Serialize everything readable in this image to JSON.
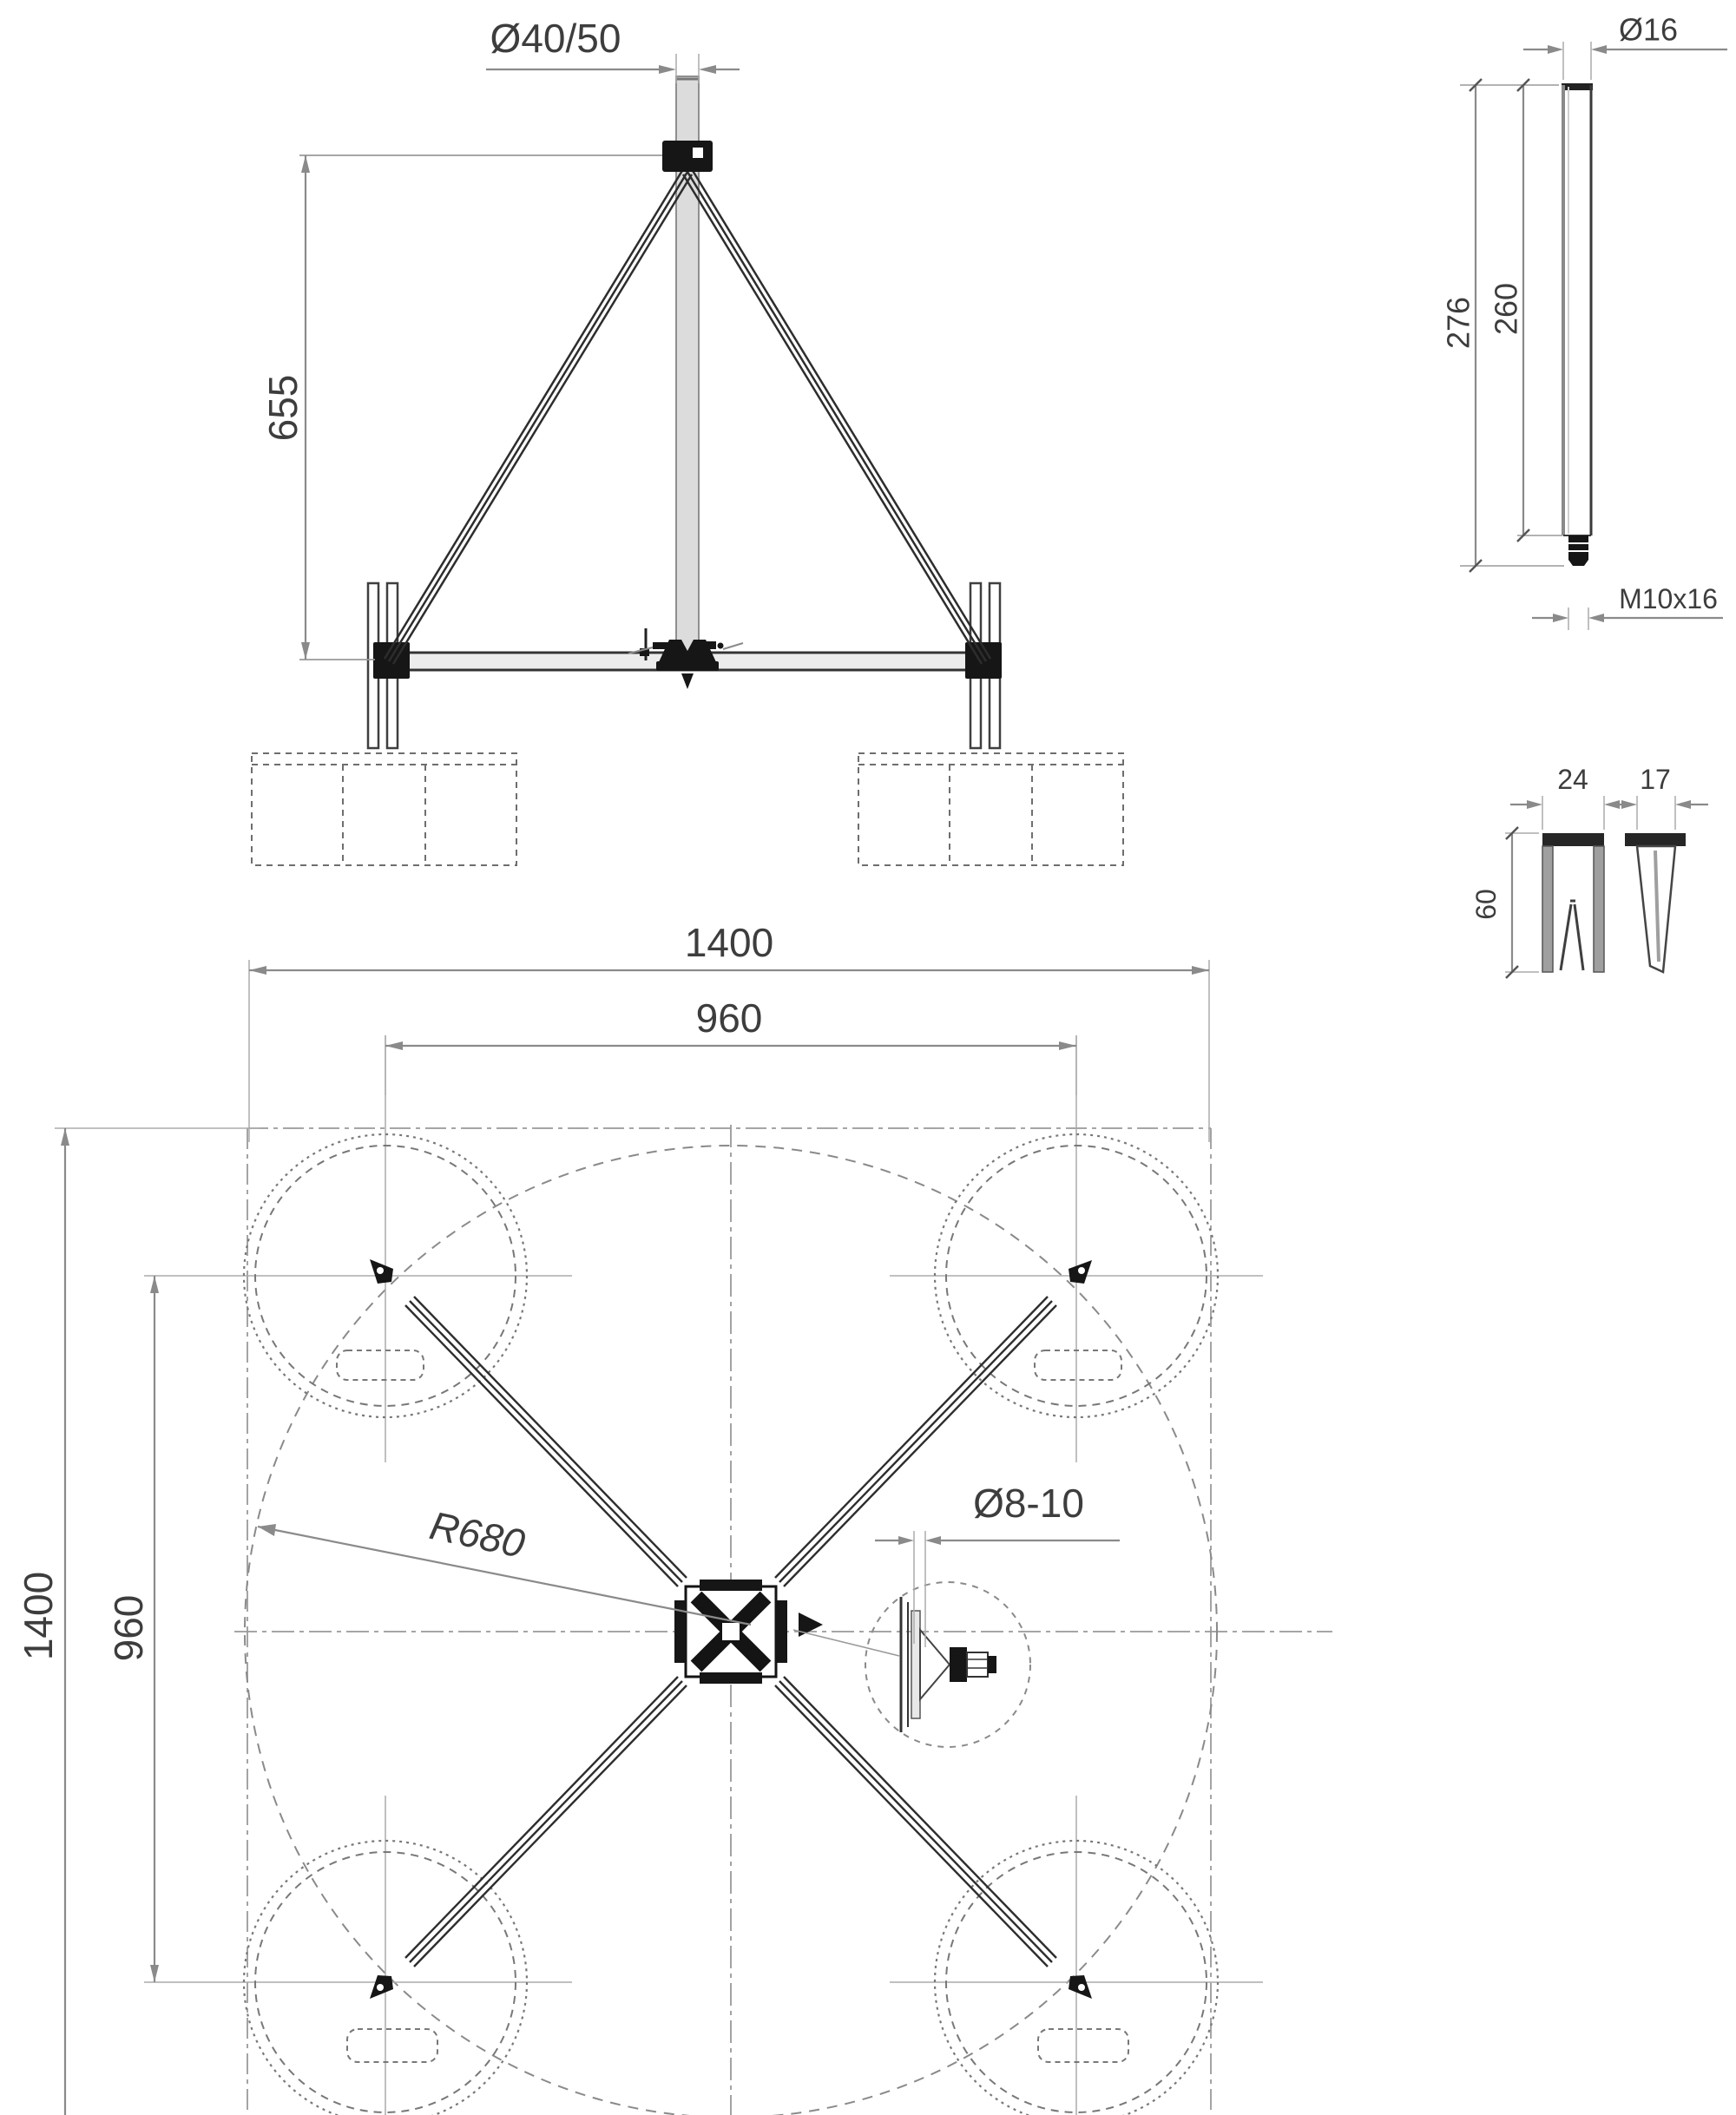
{
  "front": {
    "mast_diameter": "Ø40/50",
    "height": "655"
  },
  "rod": {
    "diameter": "Ø16",
    "overall_length": "276",
    "shaft_length": "260",
    "thread": "M10x16"
  },
  "anchor": {
    "channel_width": "24",
    "blade_width": "17",
    "depth": "60"
  },
  "plan": {
    "outer_width": "1400",
    "outer_height": "1400",
    "leg_span_h": "960",
    "leg_span_v": "960",
    "slab_circle_radius": "R680",
    "conductor_diameter": "Ø8-10"
  },
  "colors": {
    "background": "#ffffff",
    "ink": "#2d2d2d",
    "dimension": "#8a8a8a",
    "label": "#3d3d3d",
    "mast_fill": "#dcdcdc"
  }
}
